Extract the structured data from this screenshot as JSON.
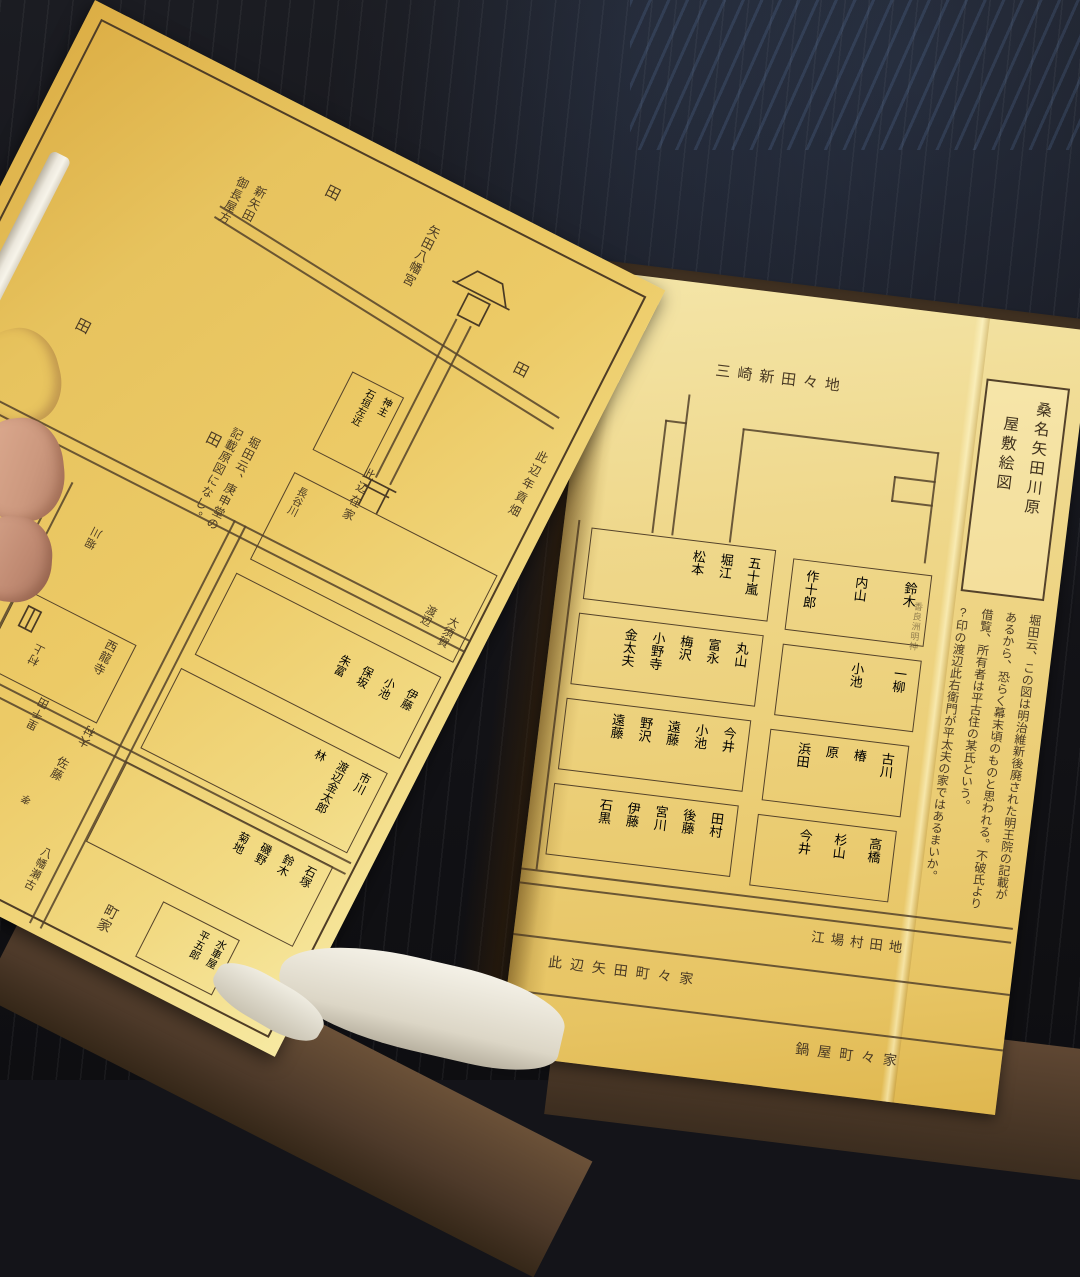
{
  "scene": {
    "description": "Photograph of an open book showing an old Japanese residence plot map on yellow paper",
    "colors": {
      "paper_left": "#e7c35e",
      "paper_right": "#eed47f",
      "ink": "#4a3a24",
      "table": "#141419",
      "book_cover": "#5a4331",
      "page_edges": "#ece8dd",
      "hand": "#d9ab92"
    }
  },
  "left_page": {
    "field_labels": [
      "田",
      "田",
      "田",
      "田"
    ],
    "shinyata_lines": [
      "新矢田",
      "御長屋方"
    ],
    "yahata_shrine_label": "矢田八幡宮",
    "koshindo_note_lines": [
      "堀田云、庚申堂の",
      "記載原図になし。"
    ],
    "kannushi_box_lines": [
      "神主",
      "石垣左近"
    ],
    "nengu_label": "此辺年貢畑",
    "zaike_label": "此辺在家",
    "box1_left_name": "長谷川",
    "box1_names": [
      "大須賀",
      "渡辺"
    ],
    "box2_names": [
      "伊藤",
      "小池",
      "保坂",
      "朱富"
    ],
    "box3_names": [
      "市川",
      "渡辺金太郎",
      "林"
    ],
    "box4_names": [
      "石塚",
      "鈴木",
      "磯野",
      "菊地"
    ],
    "suisha_box_lines": [
      "水車屋",
      "平五郎"
    ],
    "sairyuji_label": "西龍寺",
    "sato_label": "佐藤",
    "sato_small": "孝",
    "koshindo_box_label": "庚申堂",
    "manji": "卍",
    "umamichi_label": "馬道",
    "machiya_1": "町家",
    "machiya_2": "町家",
    "yahata_seko_label": "八幡瀬古",
    "rotated_labels": [
      "神明社",
      "明王院",
      "堀川",
      "村上",
      "大村",
      "里千田",
      "渡辺此右衛門"
    ],
    "question_mark": "?",
    "compass": {
      "ring": [
        "子",
        "丑",
        "寅",
        "卯",
        "辰",
        "巳",
        "午",
        "未",
        "申",
        "酉",
        "戌",
        "亥"
      ],
      "north": "北",
      "east": "東",
      "south": "南",
      "west": "西"
    }
  },
  "right_page": {
    "area_top_label": "三崎新田々地",
    "title_box_lines": [
      "桑名矢田川原",
      "屋敷絵図"
    ],
    "small_shrine_label": "香良洲明神",
    "note_lines": [
      "堀田云、この図は明治維新後廃された明王院の記載が",
      "あるから、恐らく幕末頃のものと思われる。不破氏より",
      "借覧、所有者は平古住の某氏という。",
      "?印の渡辺此右衛門が平太夫の家ではあるまいか。"
    ],
    "name_boxes": {
      "r1_left": [
        "五十嵐",
        "堀江",
        "松本"
      ],
      "r1_right": [
        "鈴木",
        "内山",
        "作十郎"
      ],
      "r2_left": [
        "丸山",
        "富永",
        "梅沢",
        "小野寺",
        "金太夫"
      ],
      "r2_right": [
        "一柳",
        "小池"
      ],
      "r3_left": [
        "今井",
        "小池",
        "遠藤",
        "野沢",
        "遠藤"
      ],
      "r3_right": [
        "古川",
        "椿",
        "原",
        "浜田"
      ],
      "r4_left": [
        "田村",
        "後藤",
        "宮川",
        "伊藤",
        "石黒"
      ],
      "r4_right": [
        "高橋",
        "杉山",
        "今井"
      ]
    },
    "bottom_labels": {
      "eba": "江場村田地",
      "yada": "此辺矢田町々家",
      "nabeya": "鍋屋町々家"
    }
  }
}
